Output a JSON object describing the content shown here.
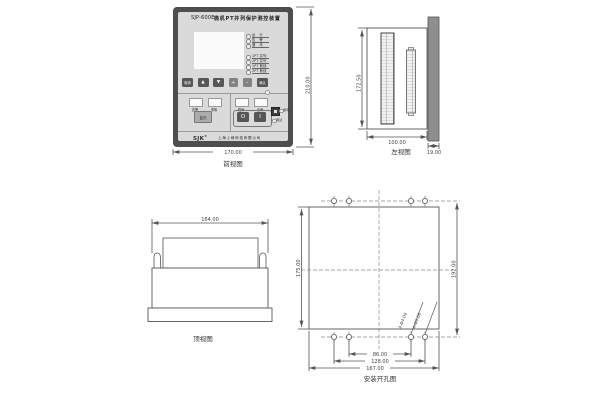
{
  "front": {
    "caption": "前视图",
    "dims": {
      "width": "170.00",
      "height": "210.00"
    },
    "device": {
      "model": "SJP-600E",
      "name": "微机PT并列保护测控装置",
      "status_leds": [
        "运 行",
        "告 警",
        "通 讯"
      ],
      "pt_leds": [
        "1PT 并列",
        "2PT 并列",
        "1PT 断线",
        "2PT 断线"
      ],
      "keys": {
        "cancel": "取消",
        "up": "▲",
        "down": "▼",
        "plus": "+",
        "minus": "-",
        "confirm": "确认"
      },
      "signal_windows": [
        "告警",
        "事故"
      ],
      "reset_key": "复归",
      "switch_windows": [
        "跳闸",
        "合闸"
      ],
      "switch_off": "O",
      "switch_on": "I",
      "comm_label": "通讯",
      "debug_label": "调试",
      "logo": "SJK",
      "logo_mark": "®",
      "company": "上海上继科技有限公司"
    }
  },
  "side": {
    "caption": "左视图",
    "dims": {
      "height": "172.50",
      "depth": "100.00",
      "panel": "19.00"
    }
  },
  "top": {
    "caption": "顶视图",
    "dims": {
      "width": "164.00"
    }
  },
  "mount": {
    "caption": "安装开孔图",
    "dims": {
      "cutout_height": "175.00",
      "hole_rows_spacing": "192.00",
      "inner_span": "86.00",
      "mid_span": "128.00",
      "outer_span": "167.00"
    },
    "hole_labels": [
      "4-Φ4.00",
      "4-Φ6.00"
    ]
  }
}
